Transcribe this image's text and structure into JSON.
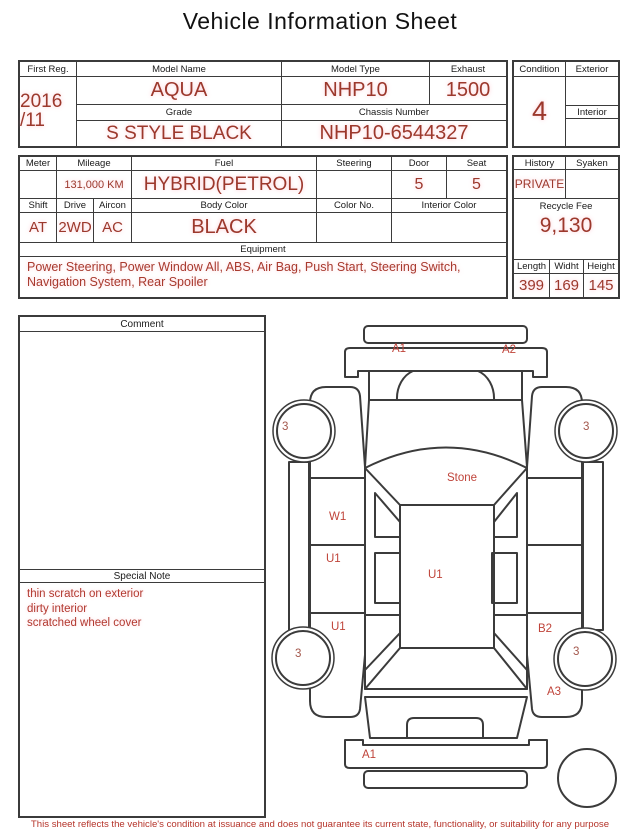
{
  "title": "Vehicle Information Sheet",
  "table1": {
    "first_reg_label": "First Reg.",
    "first_reg_line1": "2016",
    "first_reg_line2": "/11",
    "model_name_label": "Model Name",
    "model_name": "AQUA",
    "model_type_label": "Model Type",
    "model_type": "NHP10",
    "exhaust_label": "Exhaust",
    "exhaust": "1500",
    "grade_label": "Grade",
    "grade": "S STYLE BLACK",
    "chassis_label": "Chassis Number",
    "chassis": "NHP10-6544327",
    "condition_label": "Condition",
    "condition": "4",
    "exterior_label": "Exterior",
    "exterior": "",
    "interior_label": "Interior",
    "interior": ""
  },
  "table2": {
    "meter_label": "Meter",
    "meter": "",
    "mileage_label": "Mileage",
    "mileage": "131,000 KM",
    "fuel_label": "Fuel",
    "fuel": "HYBRID(PETROL)",
    "steering_label": "Steering",
    "steering": "",
    "door_label": "Door",
    "door": "5",
    "seat_label": "Seat",
    "seat": "5",
    "shift_label": "Shift",
    "shift": "AT",
    "drive_label": "Drive",
    "drive": "2WD",
    "aircon_label": "Aircon",
    "aircon": "AC",
    "body_color_label": "Body Color",
    "body_color": "BLACK",
    "color_no_label": "Color No.",
    "color_no": "",
    "interior_color_label": "Interior Color",
    "interior_color": "",
    "equipment_label": "Equipment",
    "equipment": "Power Steering, Power Window All, ABS, Air Bag, Push Start, Steering Switch, Navigation System, Rear Spoiler",
    "history_label": "History",
    "history": "PRIVATE",
    "syaken_label": "Syaken",
    "syaken": "",
    "recycle_fee_label": "Recycle Fee",
    "recycle_fee": "9,130",
    "length_label": "Length",
    "length": "399",
    "width_label": "Widht",
    "width": "169",
    "height_label": "Height",
    "height": "145"
  },
  "comment": {
    "label": "Comment",
    "text": ""
  },
  "special_note": {
    "label": "Special Note",
    "lines": [
      "thin scratch on exterior",
      "dirty interior",
      "scratched wheel cover"
    ]
  },
  "diagram": {
    "front_bumper_left": "A1",
    "front_bumper_right": "A2",
    "front_left_wheel": "3",
    "front_right_wheel": "3",
    "windshield": "Stone",
    "left_front_door": "W1",
    "left_rear_door": "U1",
    "roof": "U1",
    "left_rocker": "U1",
    "right_quarter": "B2",
    "rear_left_wheel": "3",
    "rear_right_wheel": "3",
    "right_rear_fender": "A3",
    "rear_bumper": "A1"
  },
  "footer": {
    "disclaimer": "This sheet reflects the vehicle's condition at issuance and does not guarantee its current state, functionality, or suitability for any purpose"
  },
  "colors": {
    "value_red": "#9c382c",
    "diagram_label_red": "#bf4339",
    "note_red": "#b23a30",
    "line_dark": "#3b3b3b"
  }
}
